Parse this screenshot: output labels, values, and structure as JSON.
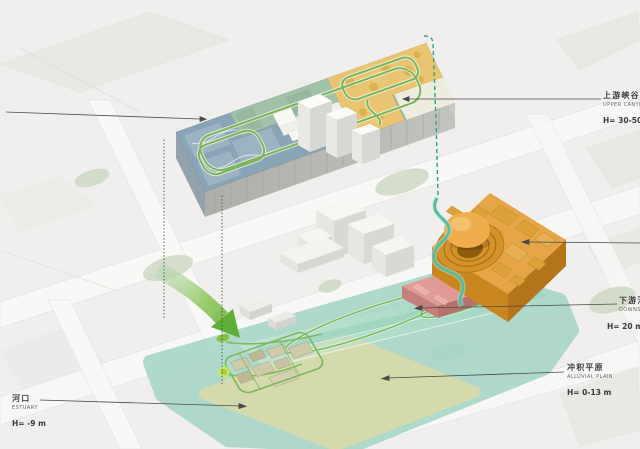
{
  "title": "axonometric campus site diagram with river-terrain analogy labels",
  "labels": {
    "upper_canyon": {
      "zh": "上游峡谷",
      "en": "UPPER CANYON",
      "height": "H= 30-50 m"
    },
    "downstream": {
      "zh": "下游河道",
      "en": "DOWNSTREAM",
      "height": "H= 20 m"
    },
    "alluvial_plain": {
      "zh": "冲积平原",
      "en": "ALLUVIAL PLAIN",
      "height": "H= 0-13 m"
    },
    "estuary": {
      "zh": "河口",
      "en": "ESTUARY",
      "height": "H= -9 m"
    }
  },
  "zones": {
    "upper_canyon_building": {
      "roof_colors": [
        "#89a4b6",
        "#a2c1a9",
        "#e9c572"
      ]
    },
    "downstream_building": {
      "roof_color": "#e6a647",
      "dome_color": "#f0ad4e"
    },
    "pink_building": {
      "roof_color": "#e09b96"
    },
    "alluvial_plain_zone": {
      "fill": "#a6d5c5"
    },
    "estuary_zone": {
      "fill": "#d9daa9"
    },
    "green_path": {
      "color": "#7ab457"
    },
    "teal_route": {
      "color": "#57bd9e"
    },
    "dashed_route": {
      "color": "#2da189"
    },
    "flow_arrow": {
      "color": "#6cb33c"
    },
    "leader_line": {
      "color": "#4a4a4a"
    }
  }
}
